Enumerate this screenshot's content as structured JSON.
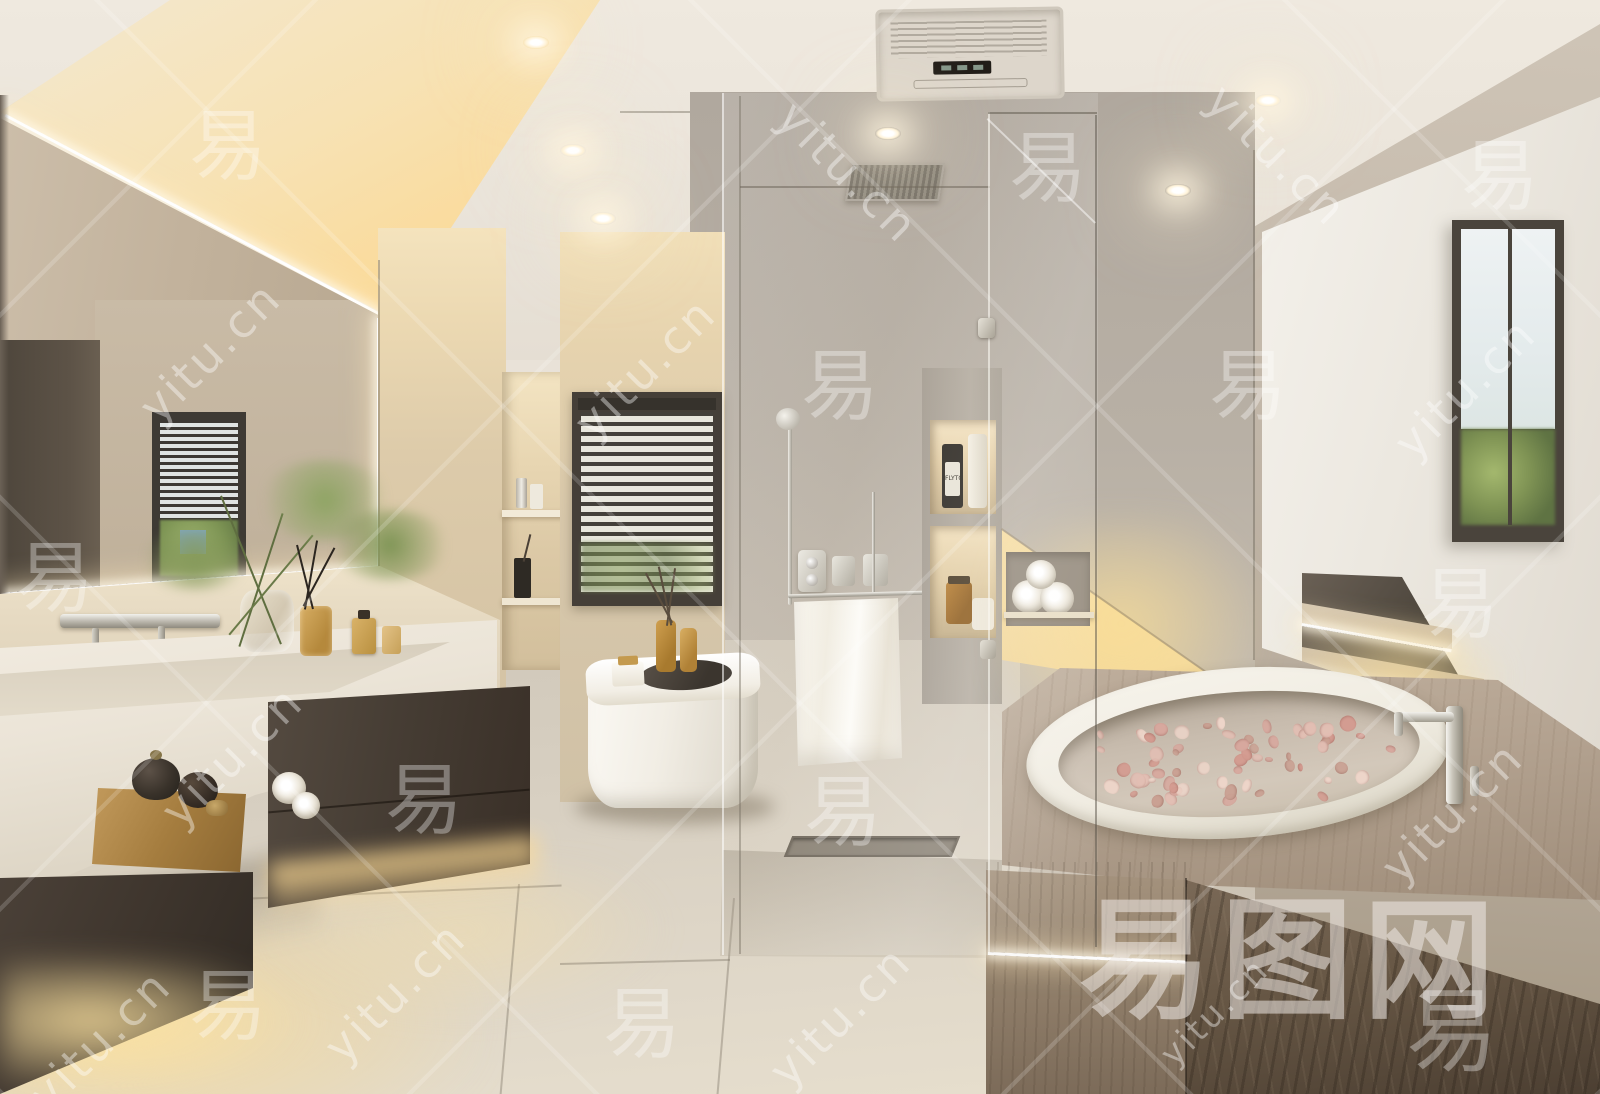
{
  "scene": {
    "description": "Photorealistic 3D render of a modern warm-beige bathroom: backlit mirror over a stone trough sink with dark floating cabinet, tea tray, backlit niches, window with dark venetian blinds above a white toilet with diffuser bottles, glass walk-in shower with chrome fixtures and hanging white towel, sunken oval bathtub with flower petals in a brown marble deck, stepped platform with LED strips, and a bright white window alcove on the right."
  },
  "palette": {
    "ceiling": "#ebe5db",
    "cove_glow": "#f8dfa4",
    "wall_warm": "#ddd2c0",
    "wall_back": "#b9b1a6",
    "wall_right": "#c3b9ab",
    "alcove_white": "#f2efe8",
    "cabinet_dark": "#483f36",
    "marble_deck": "#b3a392",
    "marble_dark": "#5e5042",
    "floor": "#dcd4c6",
    "led_warm": "#ffd98f",
    "water": "#cdc2b4",
    "petal_pink": "#d8a89e",
    "towel_white": "#f5f2ea",
    "window_frame": "#4a443c",
    "greenery": "#7d9454"
  },
  "products": {
    "shower_bottle_label": "FLYTO"
  },
  "watermark": {
    "site": "yitu.cn",
    "glyph": "易",
    "brand": "易图网",
    "items": [
      {
        "t": "url",
        "x": 210,
        "y": 352,
        "r": -45
      },
      {
        "t": "url",
        "x": 645,
        "y": 368,
        "r": -45
      },
      {
        "t": "url",
        "x": 848,
        "y": 172,
        "r": 45
      },
      {
        "t": "url",
        "x": 1277,
        "y": 155,
        "r": 45
      },
      {
        "t": "url",
        "x": 232,
        "y": 756,
        "r": -45
      },
      {
        "t": "url",
        "x": 840,
        "y": 1016,
        "r": -45
      },
      {
        "t": "url",
        "x": 100,
        "y": 1040,
        "r": -45
      },
      {
        "t": "url",
        "x": 1452,
        "y": 812,
        "r": -45
      },
      {
        "t": "url",
        "x": 1465,
        "y": 388,
        "r": -45
      },
      {
        "t": "url",
        "x": 1215,
        "y": 1012,
        "r": -45,
        "s": 34
      },
      {
        "t": "url",
        "x": 395,
        "y": 992,
        "r": -45
      },
      {
        "t": "glyph",
        "x": 228,
        "y": 140
      },
      {
        "t": "glyph",
        "x": 840,
        "y": 380
      },
      {
        "t": "glyph",
        "x": 1248,
        "y": 380
      },
      {
        "t": "glyph",
        "x": 424,
        "y": 794
      },
      {
        "t": "glyph",
        "x": 843,
        "y": 806
      },
      {
        "t": "glyph",
        "x": 1048,
        "y": 162
      },
      {
        "t": "glyph",
        "x": 1460,
        "y": 598
      },
      {
        "t": "glyph",
        "x": 228,
        "y": 1000
      },
      {
        "t": "glyph",
        "x": 642,
        "y": 1018
      },
      {
        "t": "glyph",
        "x": 55,
        "y": 572
      },
      {
        "t": "glyph",
        "x": 1500,
        "y": 170
      },
      {
        "t": "glyph",
        "x": 1452,
        "y": 1024,
        "s": 92
      }
    ]
  }
}
